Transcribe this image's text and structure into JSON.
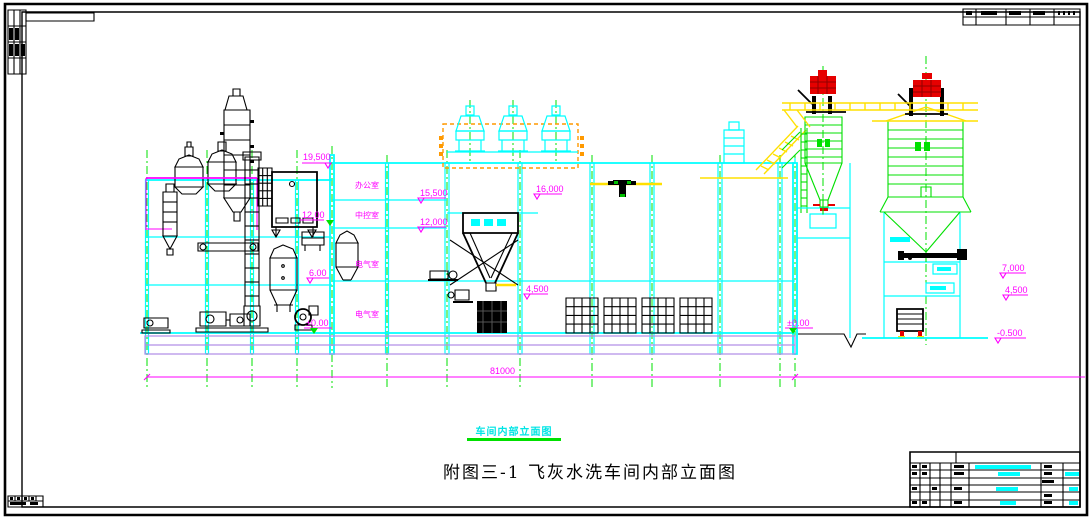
{
  "sheet": {
    "main_title": "附图三-1 飞灰水洗车间内部立面图",
    "view_label": "车间内部立面图"
  },
  "rooms": [
    "办公室",
    "中控室",
    "电气室",
    "电气室"
  ],
  "elevations": {
    "e19500": "19,500",
    "e15500": "15,500",
    "e16000": "16,000",
    "e12000": "12,000",
    "e12000_left": "12,00",
    "e6000": "6.00",
    "e0_left": "±0.00",
    "e0_right": "±0.00",
    "e4500_mid": "4,500",
    "e7000": "7,000",
    "e4500_right": "4,500",
    "em500": "-0.500"
  },
  "dimensions": {
    "overall_width": "81000"
  },
  "colors": {
    "structure": "#00ffff",
    "centerline": "#00e000",
    "annotation": "#ff00ff",
    "equipment": "#000000",
    "walkway": "#ffe000",
    "highlight_frame": "#ff9900",
    "dust_filter": "#e60000",
    "foundation": "#b28fe8"
  }
}
